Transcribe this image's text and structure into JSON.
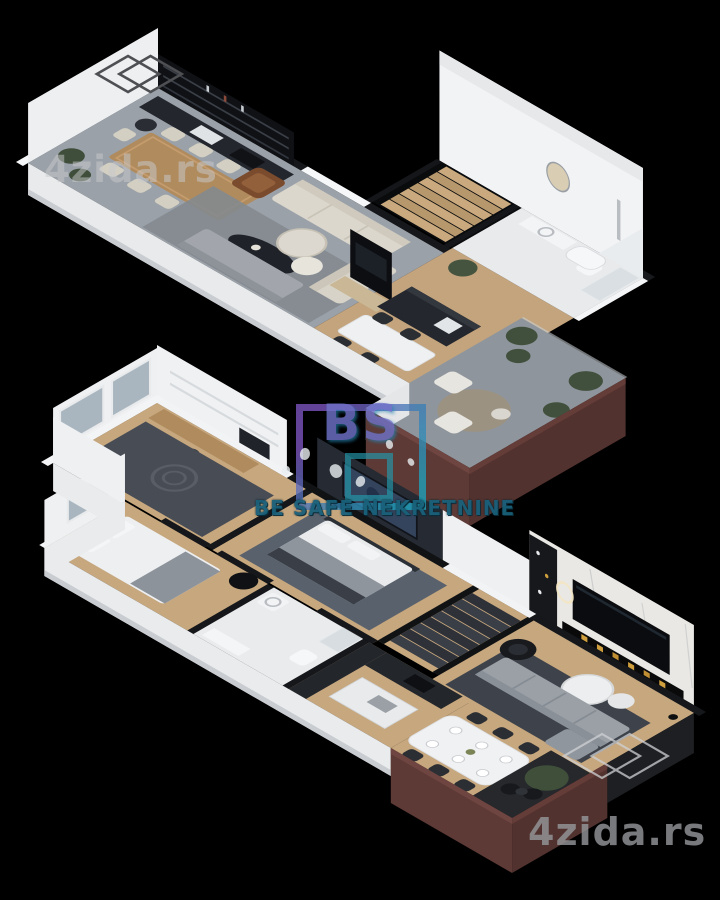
{
  "page": {
    "description": "3D isometric floor plan rendering of a duplex apartment, two levels on a black background",
    "background_color": "#000000"
  },
  "watermarks": {
    "top_left": {
      "text": "4zida.rs",
      "icon": "cube-outline-icon",
      "color": "#c9cbce"
    },
    "bottom_right": {
      "text": "4zida.rs",
      "icon": "cube-outline-icon",
      "color": "#96989b"
    }
  },
  "logo": {
    "initials": "BS",
    "caption": "BE SAFE NEKRETNINE",
    "colors": {
      "purple": "#7e57c2",
      "teal": "#1fa3bd",
      "caption": "#19607a"
    },
    "decorations": [
      "gradient-square-frame",
      "inner-square",
      "astronaut-figures"
    ]
  },
  "scene": {
    "type": "3d-floor-plan-render",
    "floors": [
      {
        "name": "upper-floor",
        "rooms": [
          "kitchen",
          "dining-area",
          "living-room",
          "hallway",
          "staircase",
          "bathroom",
          "terrace"
        ]
      },
      {
        "name": "lower-floor",
        "rooms": [
          "bedroom-with-desk",
          "bedroom",
          "master-bedroom",
          "corridor",
          "bathroom",
          "kitchen",
          "dining-area",
          "living-room",
          "staircase",
          "balcony"
        ]
      }
    ],
    "palette": {
      "floor_gray": "#9ba1a9",
      "wood": "#c3a47d",
      "wall_white": "#f2f3f5",
      "wall_dark": "#15171a",
      "accent_maroon": "#5d3a36",
      "sofa_beige": "#dbd7cc",
      "sofa_gray": "#9aa0a6",
      "rug_gray": "#84898f",
      "marble": "#e9e8e4",
      "fireplace_gold": "#cf9f3e",
      "bathroom_tile": "#e8eaec"
    }
  }
}
